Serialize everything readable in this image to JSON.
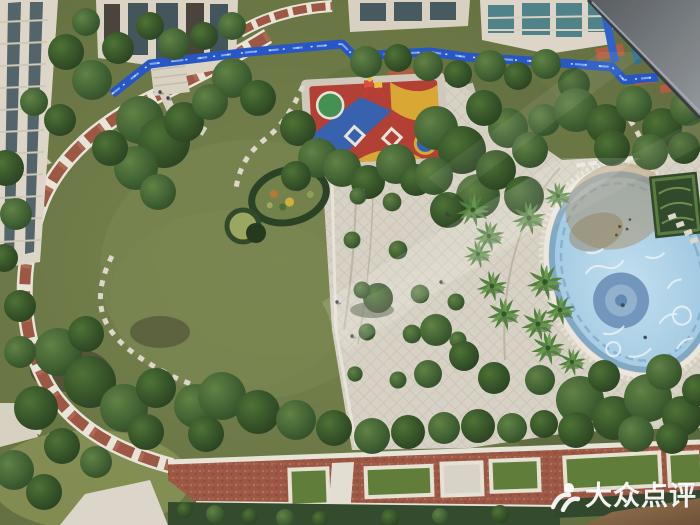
{
  "scene": {
    "type": "aerial-photograph",
    "subject": "residential-complex-courtyard",
    "view": "shot from high-rise window, window frame edge visible in top-right corner",
    "regions": [
      "apartment-buildings-top",
      "construction-fence-blue",
      "landscaped-garden-left",
      "brick-perimeter-path",
      "stepping-stone-trails",
      "flower-bed-oval",
      "children-playground-colorful",
      "central-paved-plaza",
      "palm-trees",
      "swimming-pool-empty-blue-mosaic",
      "pool-balustrade",
      "formal-hedge-parterre",
      "brick-boulevard-bottom",
      "lawn-panels",
      "tree-canopies",
      "window-frame-edge"
    ]
  },
  "watermark": {
    "brand": "Dianping",
    "text": "大众点评",
    "icon": "dianping-figure-icon",
    "color": "#ffffff"
  },
  "palette": {
    "lawn": "#66743f",
    "tree_dark": "#243c1d",
    "tree_mid": "#3a5c2c",
    "plaza_paving": "#d8d3c5",
    "brick_red": "#9c5340",
    "path_border_white": "#e9e5d9",
    "construction_fence_blue": "#2153c4",
    "pool_water_blue": "#a6cee6",
    "pool_medallion_blue": "#6f94bc",
    "pool_stain_brown": "#a38a63",
    "building_facade": "#ded7c8",
    "building_glass": "#3f5258",
    "roof_tile_orange": "#b05a3a",
    "playground_red": "#b23b2e",
    "playground_blue": "#2b5fb4",
    "playground_yellow": "#d9a62e",
    "playground_green": "#3f8f4f",
    "hedge_dark": "#2e4627",
    "soil_brown": "#8a6a4a",
    "window_frame_gray": "#6a6f73"
  }
}
